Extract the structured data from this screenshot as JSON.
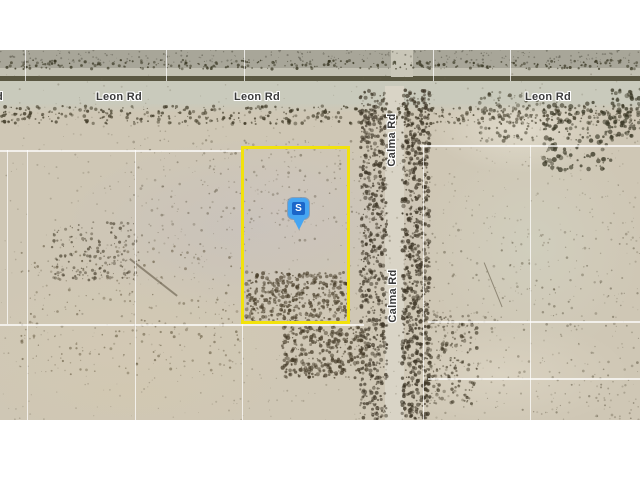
{
  "map": {
    "roads": {
      "horizontal_road_name": "Leon Rd",
      "vertical_road_name": "Calma Rd"
    },
    "marker": {
      "label": "S"
    },
    "colors": {
      "parcel_outline": "#f2e20c",
      "marker_fill": "#46a5f2",
      "marker_inner": "#1b66c9",
      "road_label_text": "#3a3a3a",
      "grid_line": "#ffffff",
      "terrain_base": "#cfc7b5",
      "road_surface": "#c9cabc",
      "road_dark_edge": "#5a5742"
    }
  }
}
